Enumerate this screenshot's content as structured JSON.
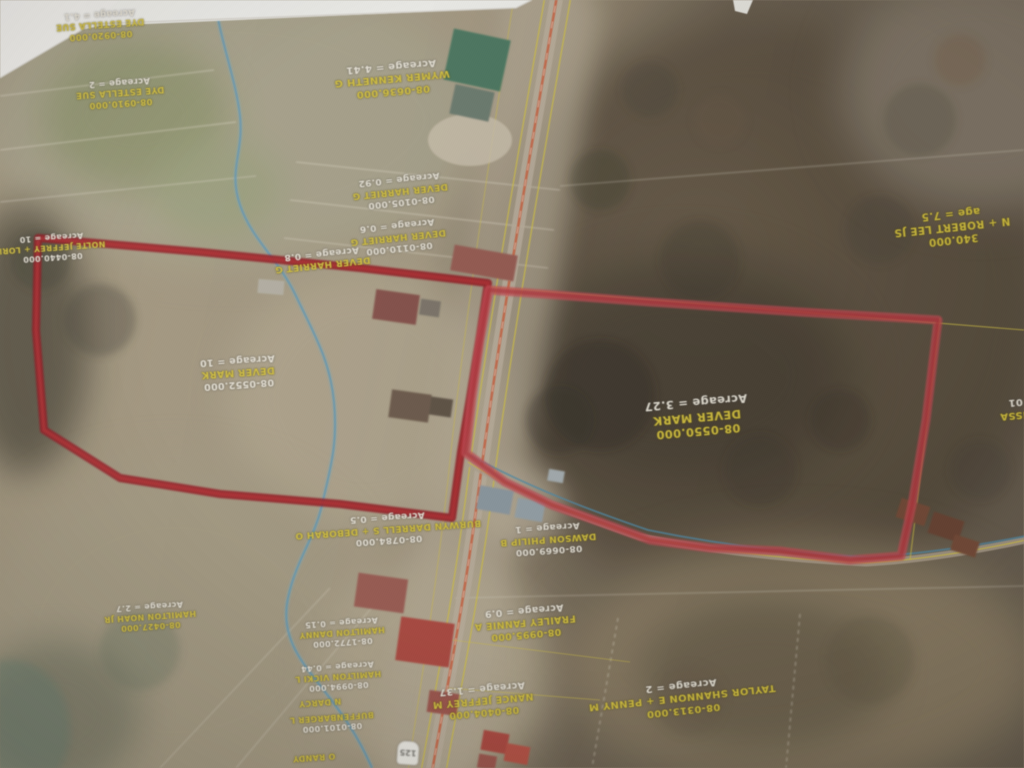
{
  "map": {
    "kind": "aerial-parcel-map-photo",
    "colors": {
      "highlight_left_outline": "#9c1117",
      "highlight_right_outline": "#cf4a52",
      "label_yellow": "#d9c435",
      "label_white": "#ece6d7",
      "parcel_line_yellow": "#d6c33c",
      "creek_blue": "#5f9ab8",
      "road_centerline": "#d4603a"
    },
    "shield": {
      "number": "125"
    },
    "labels": [
      {
        "name": "dye-upper",
        "x": 100,
        "y": 24,
        "rot": 176,
        "size": 8.5,
        "lines": [
          {
            "t": "08-0920.000",
            "c": "y"
          },
          {
            "t": "DYE ESTELLA SUE",
            "c": "y"
          },
          {
            "t": "Acreage = 4.1",
            "c": "w"
          }
        ]
      },
      {
        "name": "dye-lower",
        "x": 120,
        "y": 92,
        "rot": 176,
        "size": 8.5,
        "lines": [
          {
            "t": "08-0910.000",
            "c": "y"
          },
          {
            "t": "DYE ESTELLA SUE",
            "c": "y"
          },
          {
            "t": "Acreage = 2",
            "c": "w"
          }
        ]
      },
      {
        "name": "wymer-kenneth",
        "x": 392,
        "y": 78,
        "rot": 175,
        "size": 10,
        "lines": [
          {
            "t": "08-0636.000",
            "c": "y"
          },
          {
            "t": "WYMER KENNETH G",
            "c": "y"
          },
          {
            "t": "Acreage = 4.41",
            "c": "w"
          }
        ]
      },
      {
        "name": "robert-lee",
        "x": 952,
        "y": 226,
        "rot": 174,
        "size": 10.5,
        "lines": [
          {
            "t": "340.000",
            "c": "y"
          },
          {
            "t": "N + ROBERT LEE JS",
            "c": "y"
          },
          {
            "t": "age = 7.5",
            "c": "y"
          }
        ]
      },
      {
        "name": "dever-harriet-1",
        "x": 400,
        "y": 190,
        "rot": 174,
        "size": 9,
        "lines": [
          {
            "t": "08-0105.000",
            "c": "w"
          },
          {
            "t": "DEVER HARRIET G",
            "c": "y"
          },
          {
            "t": "Acreage = 0.92",
            "c": "w"
          }
        ]
      },
      {
        "name": "dever-harriet-2",
        "x": 398,
        "y": 236,
        "rot": 174,
        "size": 9,
        "lines": [
          {
            "t": "08-0110.000",
            "c": "w"
          },
          {
            "t": "DEVER HARRIET G",
            "c": "y"
          },
          {
            "t": "Acreage = 0.6",
            "c": "w"
          }
        ]
      },
      {
        "name": "dever-harriet-3",
        "x": 322,
        "y": 258,
        "rot": 174,
        "size": 9,
        "lines": [
          {
            "t": "DEVER HARRIET G",
            "c": "y"
          },
          {
            "t": "Acreage = 0.8",
            "c": "w"
          }
        ]
      },
      {
        "name": "nolte-jeffrey",
        "x": 52,
        "y": 247,
        "rot": 176,
        "size": 8,
        "lines": [
          {
            "t": "08-0440.000",
            "c": "w"
          },
          {
            "t": "NOLTE JEFFREY + LORI",
            "c": "y"
          },
          {
            "t": "Acreage = 10",
            "c": "w"
          }
        ]
      },
      {
        "name": "dever-mark-left",
        "x": 238,
        "y": 372,
        "rot": 176,
        "size": 9.5,
        "lines": [
          {
            "t": "08-0552.000",
            "c": "w"
          },
          {
            "t": "DEVER MARK",
            "c": "y"
          },
          {
            "t": "Acreage = 10",
            "c": "w"
          }
        ]
      },
      {
        "name": "dever-mark-right",
        "x": 697,
        "y": 417,
        "rot": 175,
        "size": 11.5,
        "lines": [
          {
            "t": "08-0550.000",
            "c": "y"
          },
          {
            "t": "DEVER MARK",
            "c": "y"
          },
          {
            "t": "Acreage = 3.27",
            "c": "w"
          }
        ]
      },
      {
        "name": "melissa-partial",
        "x": 1016,
        "y": 408,
        "rot": 175,
        "size": 10,
        "lines": [
          {
            "t": "LISSA",
            "c": "y"
          },
          {
            "t": "01",
            "c": "w"
          }
        ]
      },
      {
        "name": "burwyn-darrell",
        "x": 388,
        "y": 528,
        "rot": 176,
        "size": 9,
        "lines": [
          {
            "t": "08-0784.000",
            "c": "w"
          },
          {
            "t": "BURWYN DARRELL S + DEBORAH O",
            "c": "y"
          },
          {
            "t": "Acreage = 0.5",
            "c": "w"
          }
        ]
      },
      {
        "name": "dawson-philip",
        "x": 548,
        "y": 538,
        "rot": 176,
        "size": 9,
        "lines": [
          {
            "t": "08-0669.000",
            "c": "w"
          },
          {
            "t": "DAWSON PHILIP B",
            "c": "y"
          },
          {
            "t": "Acreage = 1",
            "c": "w"
          }
        ]
      },
      {
        "name": "frailey-fannie",
        "x": 525,
        "y": 622,
        "rot": 175,
        "size": 9.5,
        "lines": [
          {
            "t": "08-0995.000",
            "c": "y"
          },
          {
            "t": "FRAILEY FANNIE A",
            "c": "y"
          },
          {
            "t": "Acreage = 0.9",
            "c": "w"
          }
        ]
      },
      {
        "name": "nance-jeffrey",
        "x": 483,
        "y": 700,
        "rot": 175,
        "size": 9.5,
        "lines": [
          {
            "t": "08-0404.000",
            "c": "y"
          },
          {
            "t": "NANCE JEFFREY M",
            "c": "y"
          },
          {
            "t": "Acreage = 1.37",
            "c": "w"
          }
        ]
      },
      {
        "name": "taylor-shannon",
        "x": 682,
        "y": 697,
        "rot": 174,
        "size": 10,
        "lines": [
          {
            "t": "08-0313.000",
            "c": "y"
          },
          {
            "t": "TAYLOR SHANNON E + PENNY M",
            "c": "y"
          },
          {
            "t": "Acreage = 2",
            "c": "w"
          }
        ]
      },
      {
        "name": "hamilton-a",
        "x": 342,
        "y": 632,
        "rot": 176,
        "size": 8,
        "lines": [
          {
            "t": "08-1772.000",
            "c": "w"
          },
          {
            "t": "HAMILTON DANNY",
            "c": "y"
          },
          {
            "t": "Acreage = 0.15",
            "c": "w"
          }
        ]
      },
      {
        "name": "hamilton-vicki",
        "x": 338,
        "y": 676,
        "rot": 176,
        "size": 8,
        "lines": [
          {
            "t": "08-0994.000",
            "c": "w"
          },
          {
            "t": "HAMILTON VICKI L",
            "c": "y"
          },
          {
            "t": "Acreage = 0.44",
            "c": "w"
          }
        ]
      },
      {
        "name": "buffenbarger",
        "x": 332,
        "y": 722,
        "rot": 176,
        "size": 8,
        "lines": [
          {
            "t": "08-0101.000",
            "c": "w"
          },
          {
            "t": "BUFFENBARGER L",
            "c": "y"
          }
        ]
      },
      {
        "name": "hamilton-noah",
        "x": 150,
        "y": 616,
        "rot": 176,
        "size": 8,
        "lines": [
          {
            "t": "08-0427.000",
            "c": "y"
          },
          {
            "t": "HAMILTON NOAH JR",
            "c": "y"
          },
          {
            "t": "Acreage = 2.7",
            "c": "w"
          }
        ]
      },
      {
        "name": "darcy-partial",
        "x": 320,
        "y": 702,
        "rot": 176,
        "size": 8,
        "lines": [
          {
            "t": "N DARCY",
            "c": "y"
          }
        ]
      },
      {
        "name": "randy-partial",
        "x": 314,
        "y": 757,
        "rot": 176,
        "size": 8,
        "lines": [
          {
            "t": "O RANDY",
            "c": "y"
          }
        ]
      }
    ]
  }
}
